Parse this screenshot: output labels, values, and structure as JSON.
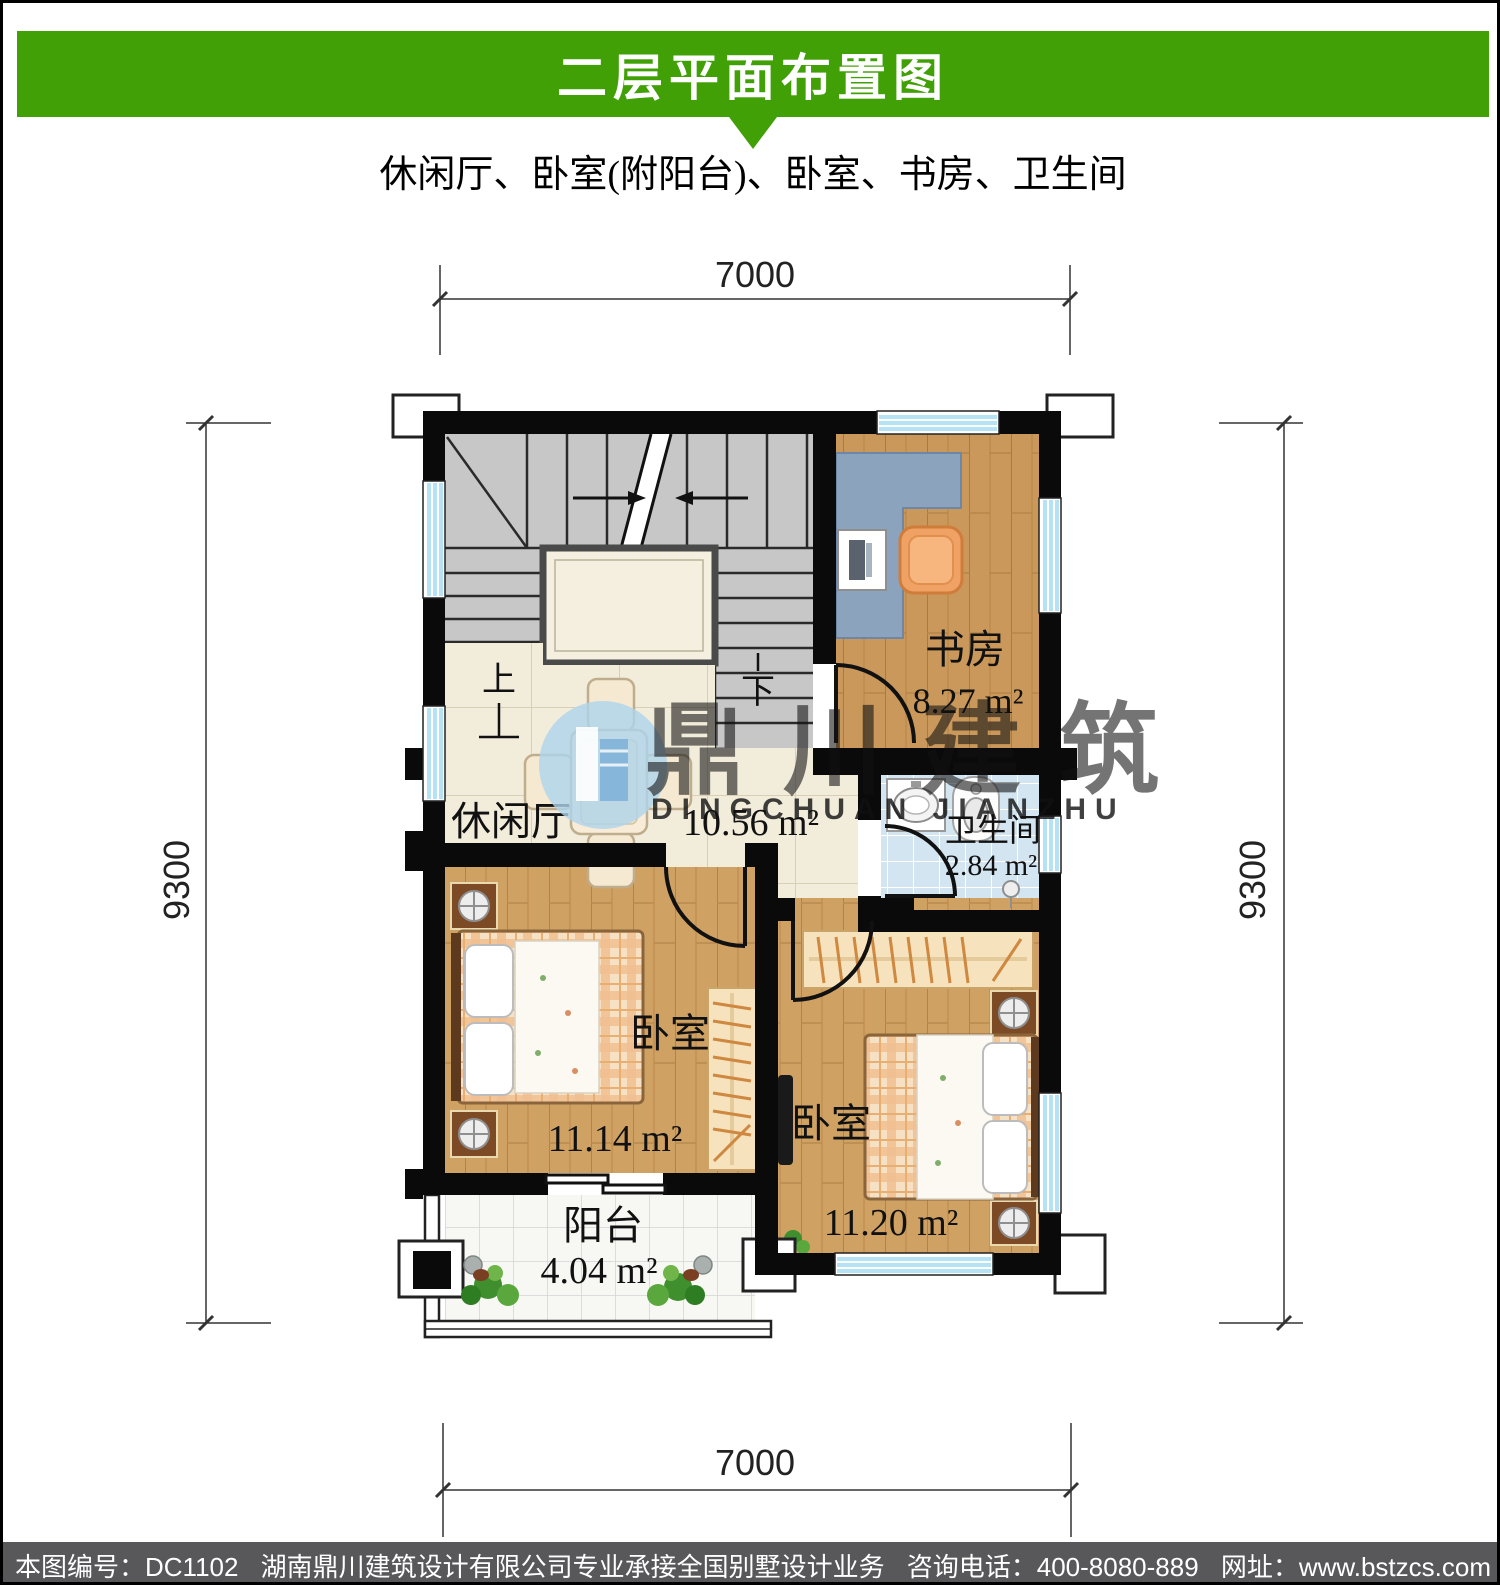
{
  "header": {
    "title": "二层平面布置图",
    "subtitle": "休闲厅、卧室(附阳台)、卧室、书房、卫生间"
  },
  "dimensions": {
    "top": "7000",
    "bottom": "7000",
    "left": "9300",
    "right": "9300"
  },
  "plan": {
    "stairs": {
      "up": "上",
      "down": "下"
    },
    "rooms": {
      "study": {
        "name": "书房",
        "area": "8.27 m²"
      },
      "bathroom": {
        "name": "卫生间",
        "area": "2.84 m²"
      },
      "lounge": {
        "name": "休闲厅",
        "area": "10.56 m²"
      },
      "bedroom_left": {
        "name": "卧室",
        "area": "11.14 m²"
      },
      "bedroom_right": {
        "name": "卧室",
        "area": "11.20 m²"
      },
      "balcony": {
        "name": "阳台",
        "area": "4.04 m²"
      }
    }
  },
  "watermark": {
    "name_cn": "鼎川建筑",
    "name_en": "DINGCHUAN JIANZHU"
  },
  "footer": {
    "drawing_no": "本图编号：DC1102",
    "company": "湖南鼎川建筑设计有限公司专业承接全国别墅设计业务",
    "phone": "咨询电话：400-8080-889",
    "website": "网址：www.bstzcs.com"
  },
  "colors": {
    "banner_green": "#41a006",
    "footer_gray": "#58585a",
    "window_blue": "#b5e3f5",
    "wall_black": "#0a0a0a"
  }
}
